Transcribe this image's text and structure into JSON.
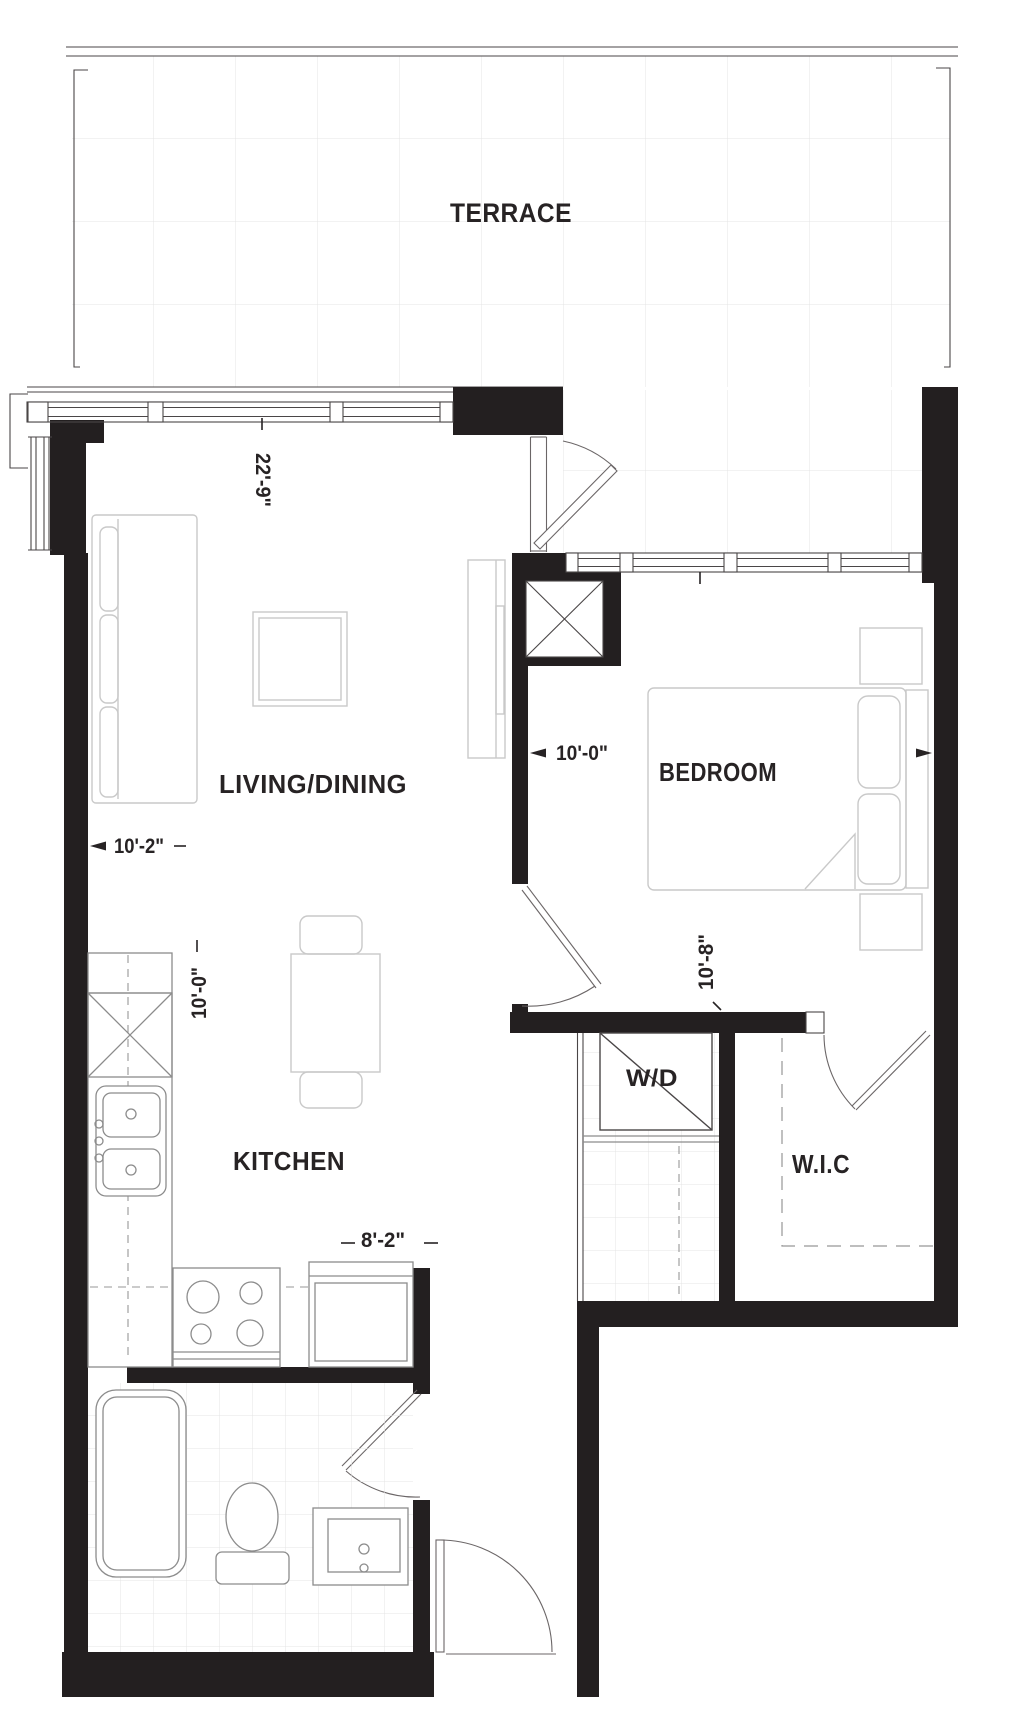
{
  "colors": {
    "bg": "#ffffff",
    "wall": "#231f20",
    "line": "#4a4647",
    "door": "#6b6667",
    "furniture": "#c9c9c9",
    "fixture": "#8c8c8c",
    "grid": "#e4e4e4",
    "dash": "#979797",
    "text": "#272324"
  },
  "rooms": {
    "terrace": {
      "label": "TERRACE"
    },
    "living_dining": {
      "label": "LIVING/DINING"
    },
    "bedroom": {
      "label": "BEDROOM"
    },
    "kitchen": {
      "label": "KITCHEN"
    },
    "laundry": {
      "label": "W/D"
    },
    "walk_in_closet": {
      "label": "W.I.C"
    }
  },
  "dimensions": {
    "living_window_width": "22'-9\"",
    "living_width": "10'-2\"",
    "bedroom_width": "10'-0\"",
    "bedroom_depth": "10'-8\"",
    "kitchen_depth": "10'-0\"",
    "kitchen_width": "8'-2\""
  }
}
